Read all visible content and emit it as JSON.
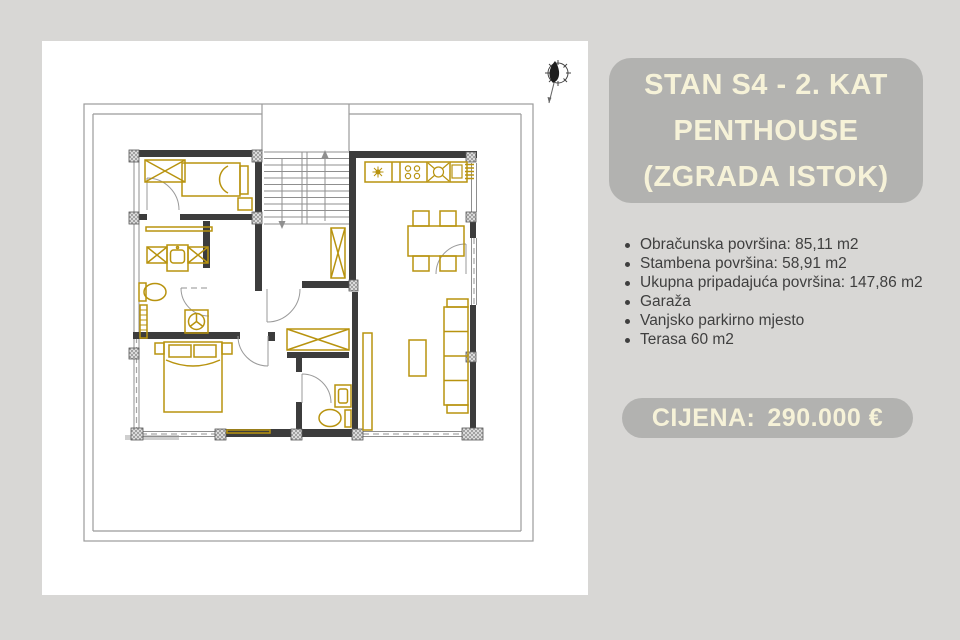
{
  "page": {
    "background_color": "#d8d7d5",
    "panel_color": "#ffffff",
    "card_color": "#b2b2b0",
    "card_text_color": "#f6f2d8",
    "body_text_color": "#3f3f3f",
    "plan_wall_color": "#3c3c3c",
    "plan_furniture_color": "#b8930f"
  },
  "listing": {
    "title_lines": [
      "STAN S4 - 2. KAT",
      "PENTHOUSE",
      "(ZGRADA ISTOK)"
    ],
    "details": [
      "Obračunska površina: 85,11 m2",
      "Stambena površina: 58,91 m2",
      "Ukupna pripadajuća površina: 147,86 m2",
      "Garaža",
      "Vanjsko parkirno mjesto",
      "Terasa 60 m2"
    ],
    "price_label": "CIJENA:",
    "price_value": "290.000 €"
  },
  "floor_plan": {
    "icons": [
      "north-arrow",
      "stairs",
      "double-bed",
      "single-bed",
      "sofa",
      "dining-table",
      "kitchen-counter",
      "toilet",
      "washing-machine",
      "sink"
    ]
  }
}
